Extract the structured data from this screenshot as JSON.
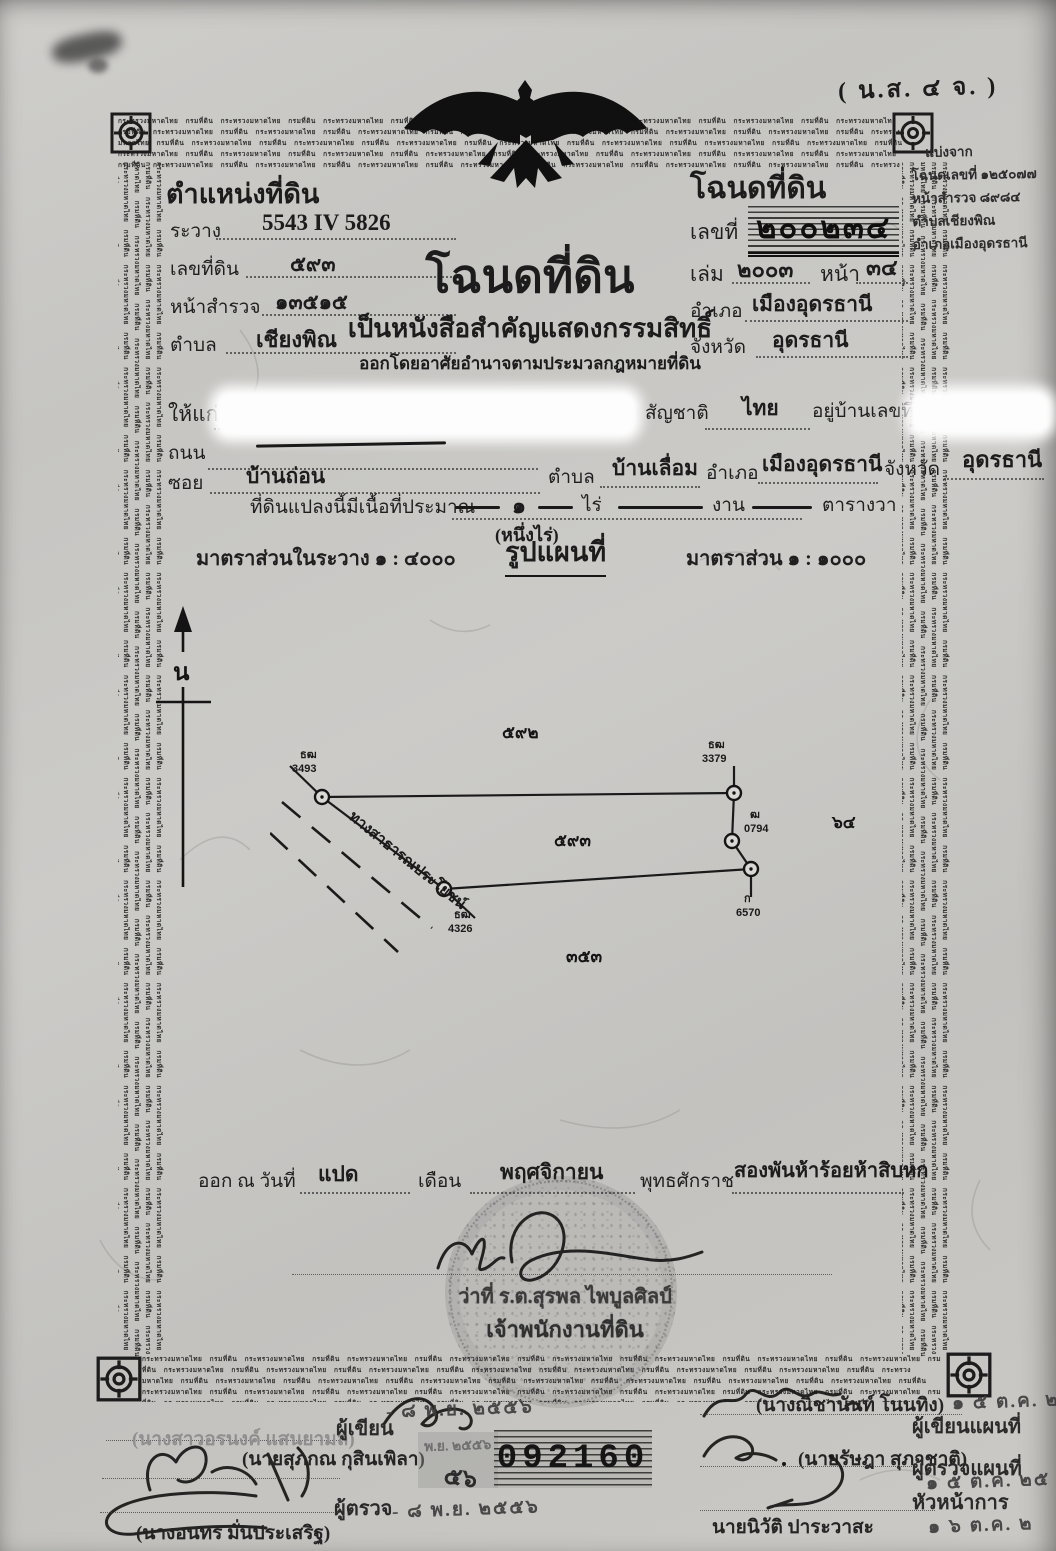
{
  "meta": {
    "form_code": "( น.ส. ๔ จ. )"
  },
  "border": {
    "microtext": "กระทรวงมหาดไทย กรมที่ดิน"
  },
  "position_block": {
    "title": "ตำแหน่งที่ดิน",
    "survey_sheet_label": "ระวาง",
    "survey_sheet": "5543 IV 5826",
    "parcel_no_label": "เลขที่ดิน",
    "parcel_no": "๕๙๓",
    "survey_page_label": "หน้าสำรวจ",
    "survey_page": "๑๓๕๑๕",
    "tambon_label": "ตำบล",
    "tambon": "เชียงพิณ"
  },
  "deed_block": {
    "title": "โฉนดที่ดิน",
    "no_label": "เลขที่",
    "no": "๒๐๐๒๓๔",
    "book_label": "เล่ม",
    "book": "๒๐๐๓",
    "page_label": "หน้า",
    "page": "๓๔",
    "amphoe_label": "อำเภอ",
    "amphoe": "เมืองอุดรธานี",
    "province_label": "จังหวัด",
    "province": "อุดรธานี"
  },
  "margin_note": {
    "line1": "แบ่งจาก",
    "line2": "โฉนดเลขที่ ๑๒๕๐๗๗",
    "line3": "หน้าสำรวจ ๘๙๘๔",
    "line4": "ตำบลเชียงพิณ",
    "line5": "อำเภอเมืองอุดรธานี"
  },
  "heading": {
    "title": "โฉนดที่ดิน",
    "subtitle": "เป็นหนังสือสำคัญแสดงกรรมสิทธิ์",
    "subtitle2": "ออกโดยอาศัยอำนาจตามประมวลกฎหมายที่ดิน"
  },
  "owner": {
    "given_to_label": "ให้แก่",
    "nationality_label": "สัญชาติ",
    "nationality": "ไทย",
    "address_label": "อยู่บ้านเลขที่",
    "road_label": "ถนน",
    "soi_label": "ซอย",
    "soi": "บ้านถ่อน",
    "tambon_label": "ตำบล",
    "tambon": "บ้านเลื่อม",
    "amphoe_label": "อำเภอ",
    "amphoe": "เมืองอุดรธานี",
    "province_label": "จังหวัด",
    "province": "อุดรธานี"
  },
  "area": {
    "label": "ที่ดินแปลงนี้มีเนื้อที่ประมาณ",
    "rai": "๑",
    "rai_label": "ไร่",
    "ngan_label": "งาน",
    "wa_label": "ตารางวา",
    "in_words": "(หนึ่งไร่)"
  },
  "scale": {
    "sheet_scale": "มาตราส่วนในระวาง ๑ : ๔๐๐๐",
    "map_title": "รูปแผนที่",
    "map_scale": "มาตราส่วน ๑ : ๑๐๐๐"
  },
  "map": {
    "north_label": "น",
    "adjacent_top": "๕๙๒",
    "parcel": "๕๙๓",
    "adjacent_right": "๖๔",
    "adjacent_bottom": "๓๕๓",
    "road_label": "ทางสาธารณประโยชน์",
    "markers": {
      "tl_prefix": "ธฒ",
      "tl": "3493",
      "tr_prefix": "ธฒ",
      "tr": "3379",
      "rm_prefix": "ฒ",
      "rm": "0794",
      "rb_prefix": "ก",
      "rb": "6570",
      "bl_prefix": "ธฒ",
      "bl": "4326"
    }
  },
  "issue": {
    "prefix": "ออก ณ วันที่",
    "day": "แปด",
    "month_label": "เดือน",
    "month": "พฤศจิกายน",
    "era_label": "พุทธศักราช",
    "year": "สองพันห้าร้อยห้าสิบหก"
  },
  "registrar": {
    "name": "ว่าที่ ร.ต.สุรพล ไพบูลศิลป์",
    "title": "เจ้าพนักงานที่ดิน"
  },
  "officials": {
    "writer_name": "(นางสาวอรนงค์ แสนยามล)",
    "writer_role": "ผู้เขียน",
    "writer_date": "- ๘ พ.ย. ๒๕๕๖",
    "checker_name": "(นายสุภกณ กุสินเพิลา)",
    "checker_role": "ผู้ตรวจ",
    "checker_date": "- ๘ พ.ย. ๒๕๕๖",
    "third_name": "(นางอนทร มั่นประเสริฐ)",
    "stamp_month": "พ.ย. ๒๕๕๖",
    "stamp_note": "๕๖",
    "serial": "092160",
    "map_writer_name": "(นางณิชานันท์ โนนทิง)",
    "map_writer_role": "ผู้เขียนแผนที่",
    "map_writer_date": "๑ ๕ ต.ค. ๒๕",
    "map_checker_name": "(นายรัษฎา สุภาชาติ)",
    "map_checker_role": "ผู้ตรวจแผนที่",
    "map_checker_date": "๑ ๕ ต.ค. ๒๕",
    "head_role": "หัวหน้าการ",
    "head_name": "นายนิวัติ ปาระวาสะ",
    "head_date": "๑ ๖ ต.ค. ๒"
  }
}
